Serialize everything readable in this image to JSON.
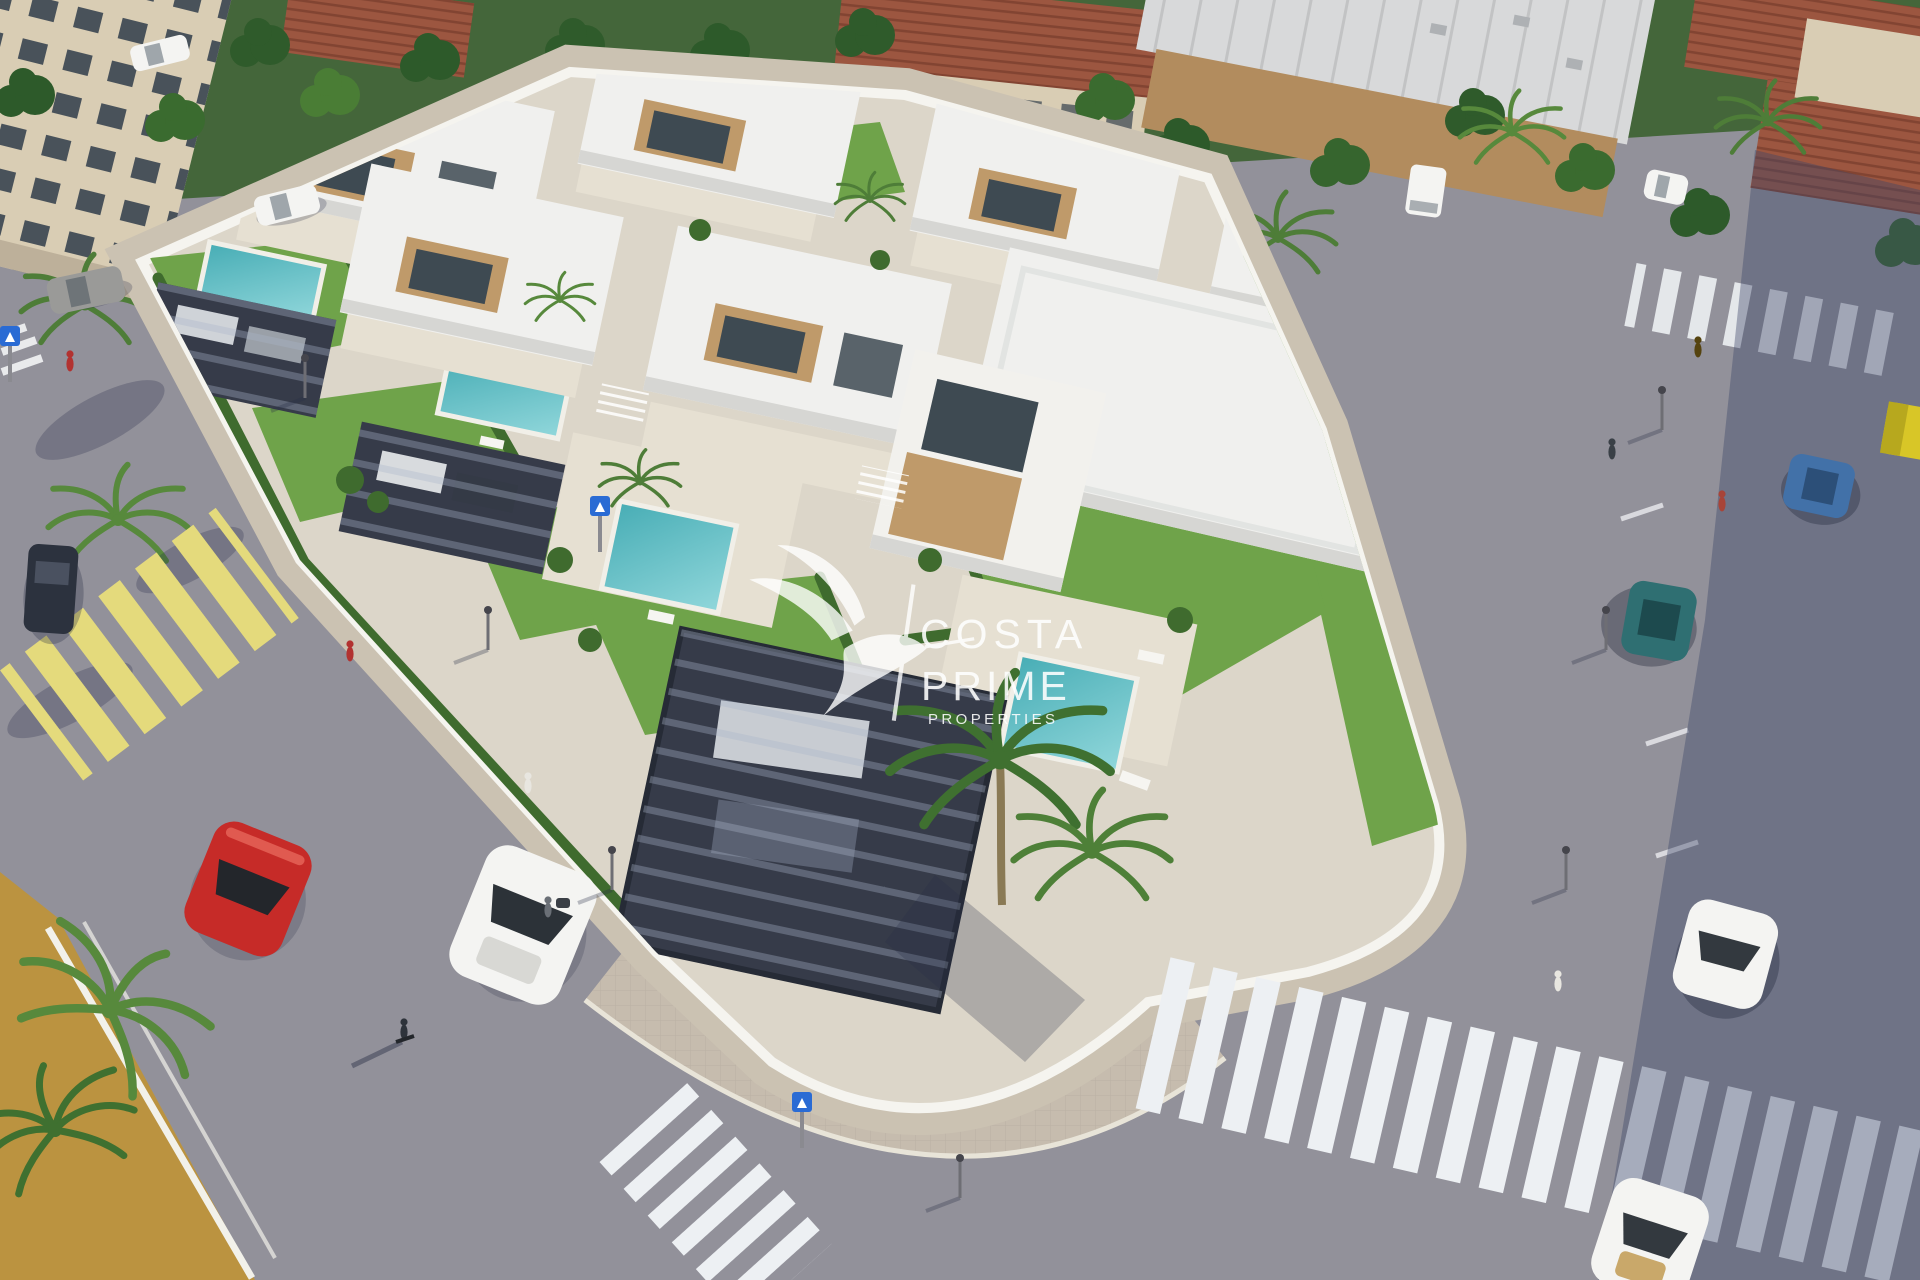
{
  "watermark": {
    "line1": "COSTA",
    "line2": "PRIME",
    "line3": "PROPERTIES",
    "logo": "hummingbird-logo"
  },
  "palette": {
    "asphalt": "#92919a",
    "asphaltShadow": "#3d4668",
    "pavement": "#cbc2b2",
    "plaza": "#c6bcae",
    "wallWhite": "#f5f4ef",
    "devBase": "#dcd6c9",
    "roofWhite": "#f0f0ee",
    "roofShade": "#d6d6d3",
    "terrace": "#e6e0d2",
    "wood": "#bf9a6a",
    "glass": "#3e4a52",
    "grass": "#6fa34a",
    "grassDark": "#49762f",
    "hedge": "#3f6b2e",
    "tree": "#2f5b2b",
    "treeLight": "#4a7d35",
    "palm": "#4e7d38",
    "pool": "#8fd6da",
    "poolDeep": "#49aeb6",
    "pergola": "#363b49",
    "ochre": "#bb9340",
    "tileRoof": "#9c5640",
    "cream": "#d9cdb4",
    "warehouseRoof": "#d8d9da",
    "warehouseWall": "#b28c5e",
    "carRed": "#c62b28",
    "carYellow": "#d8c627",
    "carBlue": "#4271a8",
    "carTeal": "#2f6f72",
    "carDark": "#2c323e",
    "carWhite": "#f4f4f2",
    "carGray": "#9a9a98",
    "signBlue": "#2a6bd4",
    "zebraWhite": "#edf0f3",
    "zebraYellow": "#e4da7c",
    "watermark": "#ffffff"
  }
}
